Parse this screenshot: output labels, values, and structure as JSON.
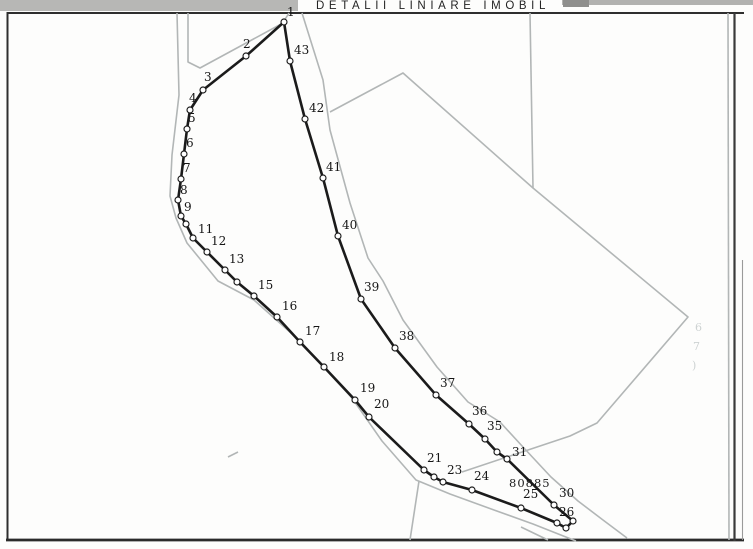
{
  "title": "DETALII LINIARE IMOBIL",
  "parcel": {
    "number": "80885",
    "label_x": 509,
    "label_y": 487
  },
  "colors": {
    "ink": "#1b1b1b",
    "gray": "#b2b6b6",
    "frame": "#2e2e2e",
    "ghost": "#cdd2d2",
    "marker_fill": "#ffffff"
  },
  "map": {
    "width": 753,
    "height": 549,
    "boundary_closed": true,
    "vertices": [
      {
        "label": "1",
        "x": 284,
        "y": 22,
        "dx": 3,
        "dy": -6
      },
      {
        "label": "2",
        "x": 246,
        "y": 56,
        "dx": -3,
        "dy": -8
      },
      {
        "label": "3",
        "x": 203,
        "y": 90,
        "dx": 1,
        "dy": -9
      },
      {
        "label": "4",
        "x": 190,
        "y": 110,
        "dx": -1,
        "dy": -8
      },
      {
        "label": "5",
        "x": 187,
        "y": 129,
        "dx": 1,
        "dy": -7
      },
      {
        "label": "6",
        "x": 184,
        "y": 154,
        "dx": 2,
        "dy": -7
      },
      {
        "label": "7",
        "x": 181,
        "y": 179,
        "dx": 2,
        "dy": -7
      },
      {
        "label": "8",
        "x": 178,
        "y": 200,
        "dx": 2,
        "dy": -6
      },
      {
        "label": "9",
        "x": 181,
        "y": 216,
        "dx": 3,
        "dy": -5
      },
      {
        "label": "",
        "x": 186,
        "y": 224,
        "dx": 0,
        "dy": 0
      },
      {
        "label": "11",
        "x": 193,
        "y": 238,
        "dx": 5,
        "dy": -5
      },
      {
        "label": "12",
        "x": 207,
        "y": 252,
        "dx": 4,
        "dy": -7
      },
      {
        "label": "13",
        "x": 225,
        "y": 270,
        "dx": 4,
        "dy": -7
      },
      {
        "label": "",
        "x": 237,
        "y": 282,
        "dx": 0,
        "dy": 0
      },
      {
        "label": "15",
        "x": 254,
        "y": 296,
        "dx": 4,
        "dy": -7
      },
      {
        "label": "16",
        "x": 277,
        "y": 317,
        "dx": 5,
        "dy": -7
      },
      {
        "label": "17",
        "x": 300,
        "y": 342,
        "dx": 5,
        "dy": -7
      },
      {
        "label": "18",
        "x": 324,
        "y": 367,
        "dx": 5,
        "dy": -6
      },
      {
        "label": "19",
        "x": 355,
        "y": 400,
        "dx": 5,
        "dy": -8
      },
      {
        "label": "20",
        "x": 369,
        "y": 417,
        "dx": 5,
        "dy": -9
      },
      {
        "label": "21",
        "x": 424,
        "y": 470,
        "dx": 3,
        "dy": -8
      },
      {
        "label": "",
        "x": 434,
        "y": 477,
        "dx": 0,
        "dy": 0
      },
      {
        "label": "23",
        "x": 443,
        "y": 482,
        "dx": 4,
        "dy": -8
      },
      {
        "label": "24",
        "x": 472,
        "y": 490,
        "dx": 2,
        "dy": -10
      },
      {
        "label": "25",
        "x": 521,
        "y": 508,
        "dx": 2,
        "dy": -10
      },
      {
        "label": "26",
        "x": 557,
        "y": 523,
        "dx": 2,
        "dy": -7
      },
      {
        "label": "",
        "x": 566,
        "y": 528,
        "dx": 0,
        "dy": 0
      },
      {
        "label": "",
        "x": 573,
        "y": 521,
        "dx": 0,
        "dy": 0
      },
      {
        "label": "30",
        "x": 554,
        "y": 505,
        "dx": 5,
        "dy": -8
      },
      {
        "label": "31",
        "x": 507,
        "y": 459,
        "dx": 5,
        "dy": -3
      },
      {
        "label": "",
        "x": 497,
        "y": 452,
        "dx": 0,
        "dy": 0
      },
      {
        "label": "35",
        "x": 485,
        "y": 439,
        "dx": 2,
        "dy": -9
      },
      {
        "label": "36",
        "x": 469,
        "y": 424,
        "dx": 3,
        "dy": -9
      },
      {
        "label": "37",
        "x": 436,
        "y": 395,
        "dx": 4,
        "dy": -8
      },
      {
        "label": "38",
        "x": 395,
        "y": 348,
        "dx": 4,
        "dy": -8
      },
      {
        "label": "39",
        "x": 361,
        "y": 299,
        "dx": 3,
        "dy": -8
      },
      {
        "label": "40",
        "x": 338,
        "y": 236,
        "dx": 4,
        "dy": -7
      },
      {
        "label": "41",
        "x": 323,
        "y": 178,
        "dx": 3,
        "dy": -7
      },
      {
        "label": "42",
        "x": 305,
        "y": 119,
        "dx": 4,
        "dy": -7
      },
      {
        "label": "43",
        "x": 290,
        "y": 61,
        "dx": 4,
        "dy": -7
      }
    ],
    "gray_lines": [
      {
        "name": "road-west-edge",
        "points": [
          [
            177,
            13
          ],
          [
            179,
            95
          ],
          [
            172,
            155
          ],
          [
            170,
            196
          ],
          [
            176,
            218
          ],
          [
            187,
            243
          ],
          [
            218,
            281
          ],
          [
            254,
            300
          ],
          [
            300,
            341
          ],
          [
            352,
            398
          ],
          [
            382,
            441
          ],
          [
            416,
            480
          ],
          [
            450,
            494
          ],
          [
            494,
            510
          ],
          [
            533,
            524
          ],
          [
            576,
            541
          ]
        ]
      },
      {
        "name": "road-north-edge",
        "points": [
          [
            188,
            13
          ],
          [
            188,
            62
          ],
          [
            200,
            68
          ],
          [
            283,
            23
          ]
        ]
      },
      {
        "name": "top-stub",
        "points": [
          [
            289,
            13
          ],
          [
            284,
            21
          ]
        ]
      },
      {
        "name": "road-east-edge",
        "points": [
          [
            302,
            13
          ],
          [
            323,
            80
          ],
          [
            330,
            130
          ],
          [
            350,
            203
          ],
          [
            368,
            258
          ],
          [
            383,
            281
          ],
          [
            403,
            320
          ],
          [
            437,
            367
          ],
          [
            468,
            402
          ],
          [
            500,
            422
          ],
          [
            523,
            447
          ],
          [
            551,
            477
          ],
          [
            578,
            501
          ],
          [
            603,
            520
          ],
          [
            627,
            538
          ]
        ]
      },
      {
        "name": "adjacent-parcel-boundary",
        "points": [
          [
            330,
            112
          ],
          [
            403,
            73
          ],
          [
            533,
            188
          ],
          [
            688,
            317
          ],
          [
            597,
            423
          ],
          [
            570,
            436
          ],
          [
            528,
            450
          ],
          [
            462,
            472
          ]
        ]
      },
      {
        "name": "vertical-parcel-line",
        "points": [
          [
            530,
            13
          ],
          [
            533,
            188
          ]
        ]
      },
      {
        "name": "branch-line",
        "points": [
          [
            419,
            481
          ],
          [
            410,
            540
          ]
        ]
      },
      {
        "name": "inner-right-line",
        "points": [
          [
            728,
            13
          ],
          [
            729,
            540
          ]
        ]
      },
      {
        "name": "bottom-stub",
        "points": [
          [
            521,
            527
          ],
          [
            548,
            540
          ]
        ]
      },
      {
        "name": "scratch-mark",
        "points": [
          [
            228,
            457
          ],
          [
            238,
            452
          ]
        ]
      }
    ],
    "ghost_marks": [
      {
        "text": "6",
        "x": 695,
        "y": 331
      },
      {
        "text": "7",
        "x": 693,
        "y": 350
      },
      {
        "text": ")",
        "x": 692,
        "y": 369
      }
    ]
  }
}
